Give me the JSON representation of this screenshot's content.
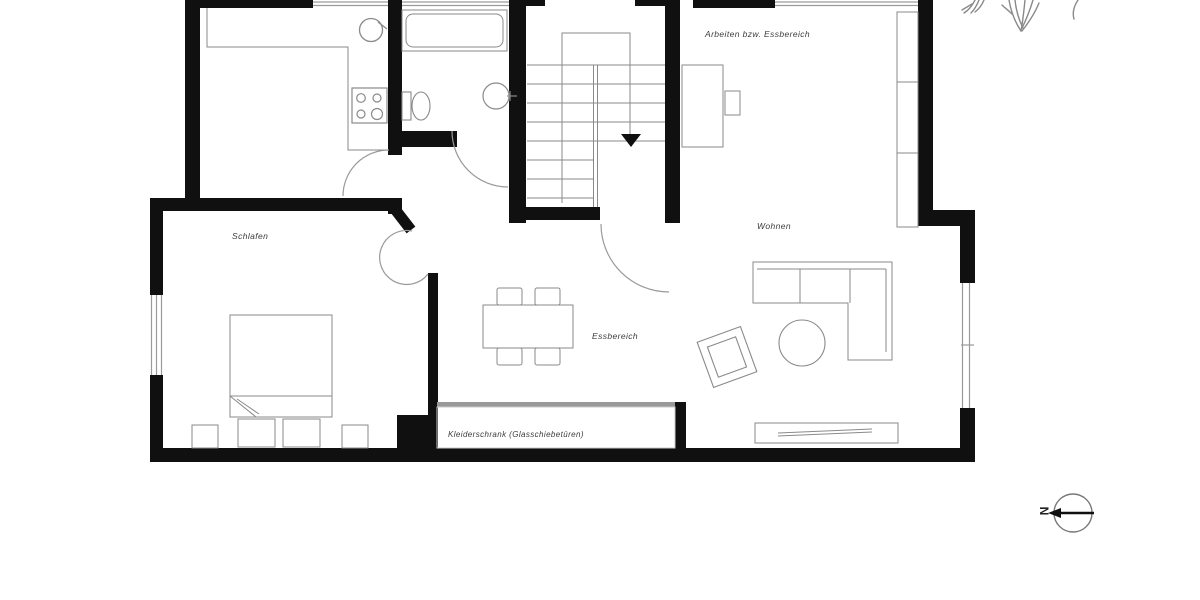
{
  "labels": {
    "schlafen": "Schlafen",
    "essbereich": "Essbereich",
    "wohnen": "Wohnen",
    "arbeiten": "Arbeiten bzw. Essbereich",
    "kleiderschrank": "Kleiderschrank (Glasschiebetüren)"
  },
  "compass": {
    "letter": "N"
  },
  "colors": {
    "wall": "#101010",
    "furniture_line": "#8a8a8a",
    "window_line": "#9a9a9a",
    "label_text": "#3c3c3c",
    "wardrobe_track": "#999999",
    "background": "#ffffff"
  },
  "fixtures": [
    "staircase-down",
    "bathtub",
    "toilet",
    "washbasin",
    "kitchen-sink",
    "stove",
    "kitchen-counter",
    "bed",
    "nightstands",
    "pillows",
    "dining-table",
    "dining-chairs",
    "corner-sofa",
    "coffee-table",
    "armchair",
    "sideboard",
    "bookshelf",
    "desk",
    "desk-chair",
    "wardrobe-sliding-doors",
    "north-arrow",
    "tree-sketch"
  ]
}
